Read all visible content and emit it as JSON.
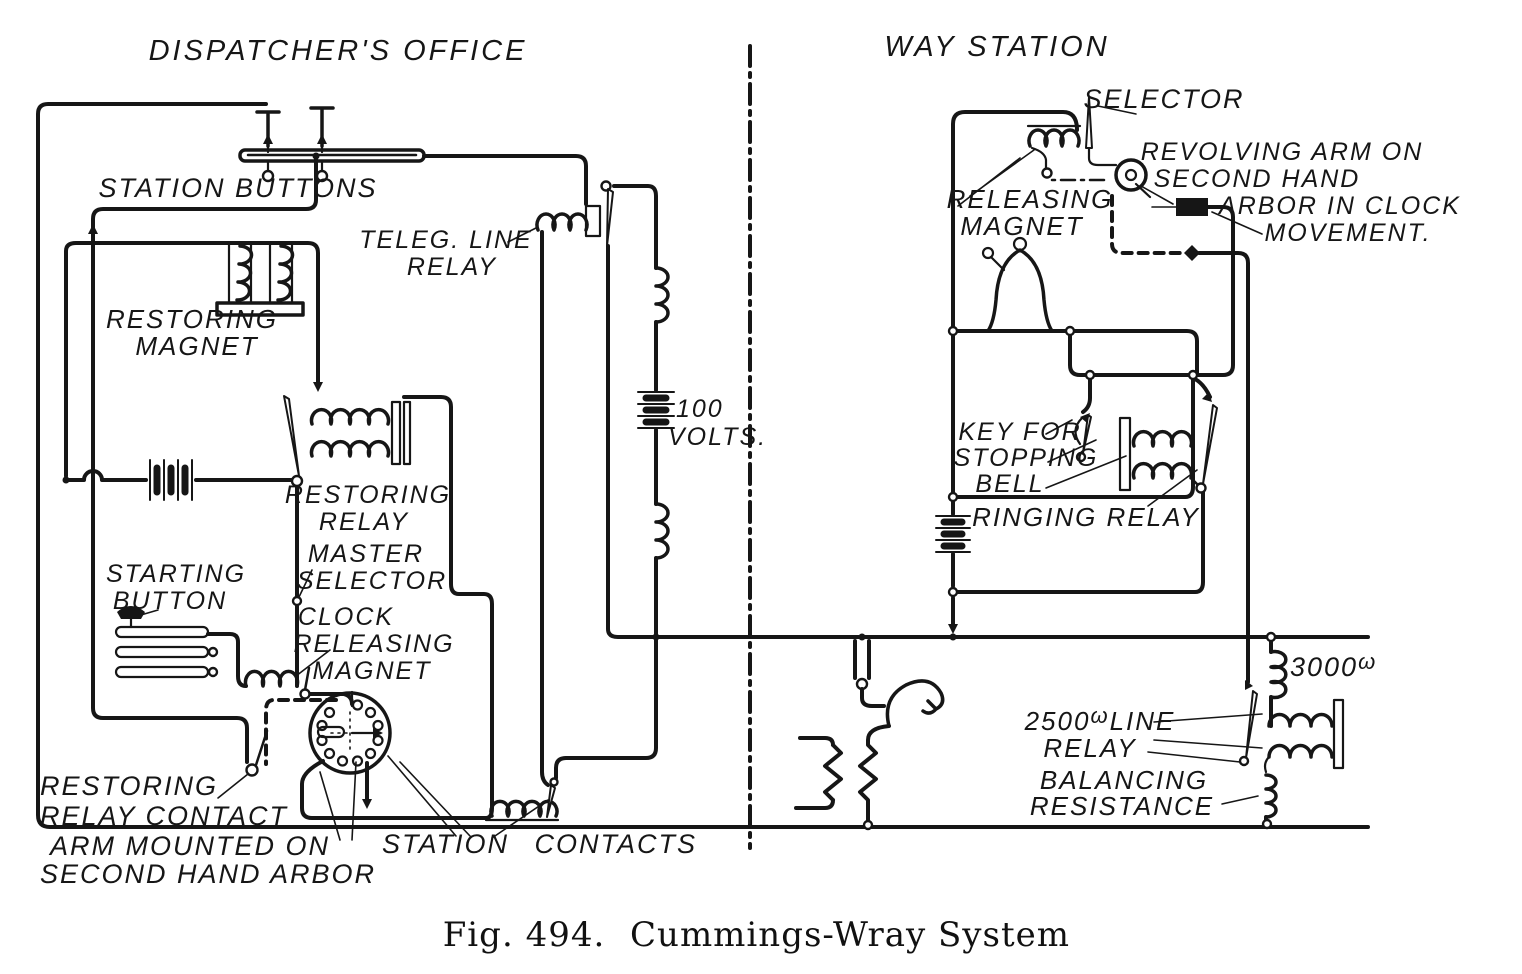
{
  "canvas": {
    "ink": "#161616",
    "paper": "#ffffff"
  },
  "sections": {
    "left": "DISPATCHER'S OFFICE",
    "right": "WAY STATION"
  },
  "dispatcher_labels": {
    "station_buttons": "STATION BUTTONS",
    "teleg_line_relay": [
      "TELEG. LINE",
      "RELAY"
    ],
    "restoring_magnet": [
      "RESTORING",
      "MAGNET"
    ],
    "restoring_relay": [
      "RESTORING",
      "RELAY"
    ],
    "master_selector": [
      "MASTER",
      "SELECTOR"
    ],
    "starting_button": [
      "STARTING",
      "BUTTON"
    ],
    "clock_releasing_magnet": [
      "CLOCK",
      "RELEASING",
      "MAGNET"
    ],
    "restoring_relay_contact": [
      "RESTORING",
      "RELAY CONTACT"
    ],
    "arm_mounted_on": [
      "ARM MOUNTED ON",
      "SECOND HAND ARBOR"
    ],
    "station_contacts": "STATION CONTACTS",
    "line_battery": [
      "100",
      "VOLTS."
    ]
  },
  "way_station_labels": {
    "selector": "SELECTOR",
    "releasing_magnet": [
      "RELEASING",
      "MAGNET"
    ],
    "revolving_arm": [
      "REVOLVING ARM ON",
      "SECOND HAND",
      "ARBOR IN CLOCK",
      "MOVEMENT."
    ],
    "key_for_stopping_bell": [
      "KEY FOR",
      "STOPPING",
      "BELL"
    ],
    "ringing_relay": "RINGING RELAY",
    "shunt_resistance": {
      "value": "3000",
      "unit": "ω"
    },
    "line_relay": {
      "value": "2500",
      "unit": "ω",
      "suffix": "LINE",
      "line2": "RELAY"
    },
    "balancing_resistance": [
      "BALANCING",
      "RESISTANCE"
    ]
  },
  "caption": {
    "figure": "Fig. 494.",
    "title": "Cummings-Wray System"
  }
}
